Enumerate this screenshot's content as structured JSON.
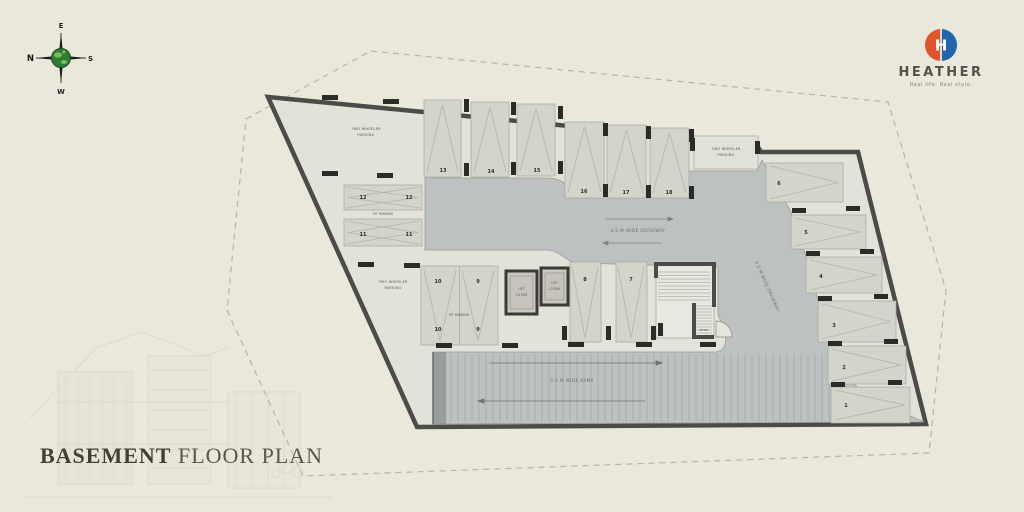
{
  "compass": {
    "n": "N",
    "e": "E",
    "s": "S",
    "w": "W"
  },
  "brand": {
    "name": "HEATHER",
    "tagline": "Real life. Real style."
  },
  "title": {
    "bold": "BASEMENT",
    "regular": " FLOOR PLAN"
  },
  "plan": {
    "numbers": [
      "1",
      "2",
      "3",
      "4",
      "5",
      "6",
      "7",
      "8",
      "9",
      "10",
      "11",
      "12",
      "13",
      "14",
      "15",
      "16",
      "17",
      "18"
    ],
    "labels": {
      "two_wheeler_1": "TWO WHEELER",
      "two_wheeler_2": "PARKING",
      "pit": "PIT PARKING",
      "lift": "LIFT",
      "lift1_cap": "10 PAX",
      "lift2_cap": "12 PAX",
      "driveway": "4.5 M WIDE DRIVEWAY",
      "ramp": "5.5 M WIDE RAMP",
      "entry": "ENTRY"
    }
  }
}
